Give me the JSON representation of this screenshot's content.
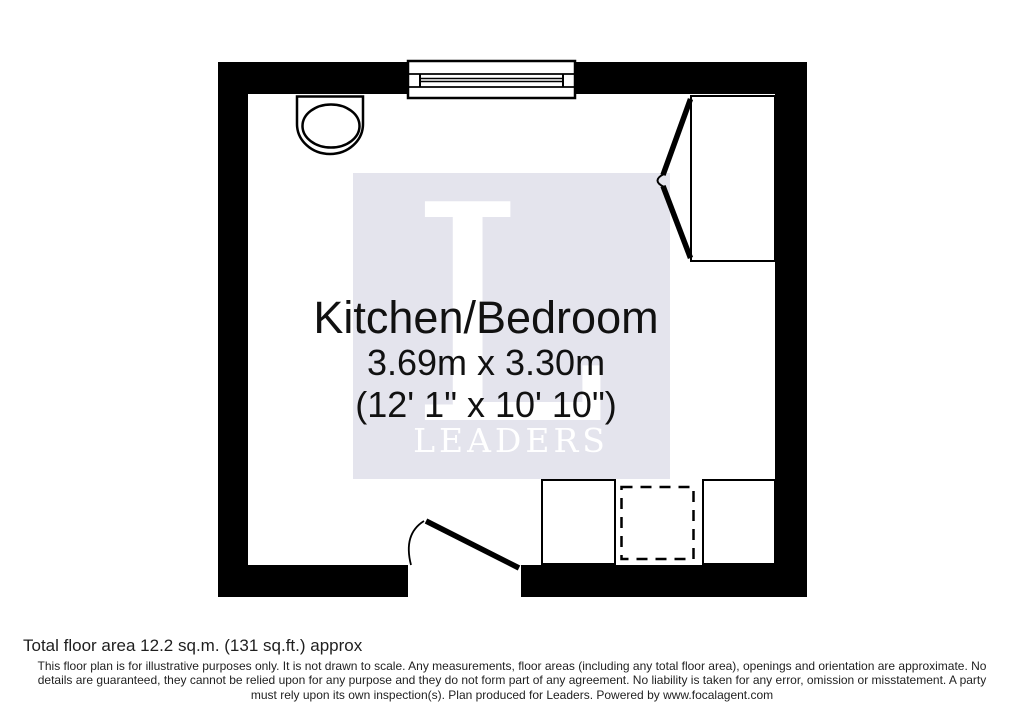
{
  "floorplan": {
    "room_label": "Kitchen/Bedroom",
    "dimensions_metric": "3.69m x 3.30m",
    "dimensions_imperial": "(12' 1\" x 10' 10\")"
  },
  "watermark": {
    "initial": "L",
    "brand": "LEADERS"
  },
  "footer": {
    "total_area": "Total floor area 12.2 sq.m. (131 sq.ft.) approx",
    "disclaimer_lines": [
      "This floor plan is for illustrative purposes only. It is not drawn to scale. Any measurements, floor areas (including any total floor area), openings and orientation are approximate. No",
      "details are guaranteed, they cannot be relied upon for any purpose and they do not form part of any agreement. No liability is taken for any error, omission or misstatement. A party",
      "must rely upon its own inspection(s). Plan produced for Leaders. Powered by www.focalagent.com"
    ]
  },
  "colors": {
    "wall": "#000000",
    "watermark_bg": "#e4e4ed",
    "watermark_text": "#ffffff",
    "label_text": "#111111",
    "footer_text": "#1f1f1f"
  }
}
